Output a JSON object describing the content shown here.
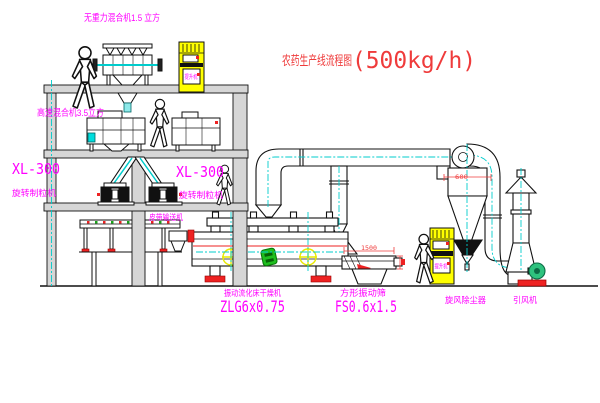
{
  "title": {
    "text": "农药生产线流程图",
    "capacity": "(500kg/h)"
  },
  "equipment_labels": {
    "gravity_free_mixer": "无重力混合机1.5 立方",
    "high_speed_mixer": "高速混合机3.5立方",
    "granulator_left_model": "XL-300",
    "granulator_left_name": "旋转制粒机",
    "granulator_right_model": "XL-300",
    "granulator_right_name": "旋转制粒机",
    "belt_conveyor": "皮带输送机",
    "fluid_bed_dryer_name": "振动流化床干燥机",
    "fluid_bed_dryer_model": "ZLG6x0.75",
    "vibrating_screen_name": "方形振动筛",
    "vibrating_screen_model": "FS0.6x1.5",
    "cyclone_dust_collector": "旋风除尘器",
    "induced_draft_fan": "引风机",
    "bucket_elevator_top": "提升机",
    "bucket_elevator_bottom": "提升机"
  },
  "dimensions": {
    "screen_length": "1500",
    "cyclone_diameter": "600"
  },
  "colors": {
    "label_magenta": "#FF00FF",
    "annotation_red": "#EF3B3B",
    "centerline_cyan": "#00CCCC",
    "equipment_yellow": "#FFFF00",
    "motor_green": "#1FBF1F",
    "fan_motor_green": "#2EC27E",
    "structure_gray": "#D6D6D6"
  }
}
